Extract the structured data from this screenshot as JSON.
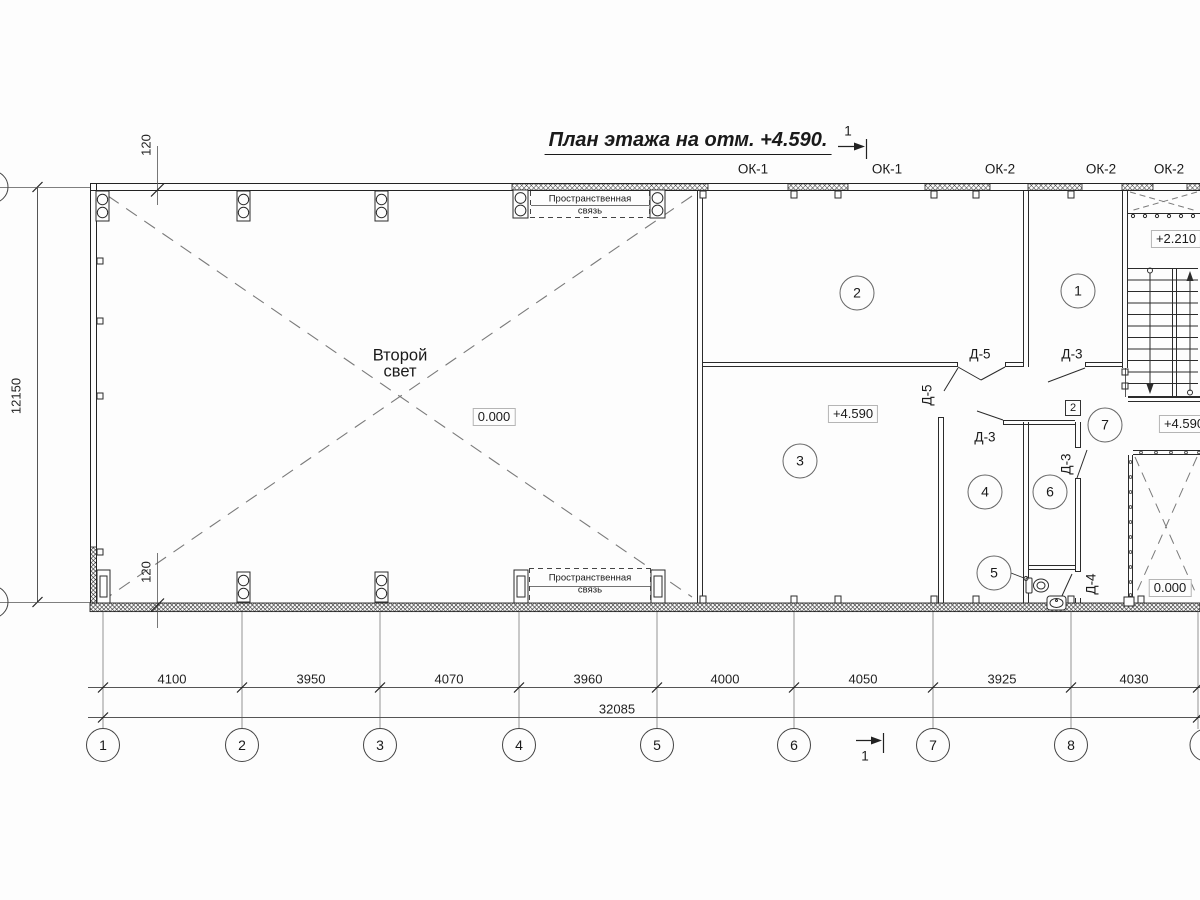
{
  "title": "План этажа на отм. +4.590.",
  "section": {
    "label": "1"
  },
  "windows": {
    "w1": "ОК-1",
    "w2": "ОК-1",
    "w3": "ОК-2",
    "w4": "ОК-2",
    "w5": "ОК-2"
  },
  "doors": {
    "d5_top": "Д-5",
    "d3_top": "Д-3",
    "d3_corr": "Д-3",
    "d5_side": "Д-5",
    "d3_side": "Д-3",
    "d4": "Д-4"
  },
  "rooms": {
    "r1": "1",
    "r2": "2",
    "r3": "3",
    "r4": "4",
    "r5": "5",
    "r6": "6",
    "r7": "7"
  },
  "marker_node": "2",
  "labels": {
    "second_light_1": "Второй",
    "second_light_2": "свет",
    "space_frame_1": "Пространственная",
    "space_frame_2": "связь"
  },
  "elevations": {
    "big_room": "0.000",
    "room3": "+4.590",
    "landing": "+2.210",
    "stair_right": "+4.590",
    "void": "0.000"
  },
  "dimensions": {
    "bays": [
      "4100",
      "3950",
      "4070",
      "3960",
      "4000",
      "4050",
      "3925",
      "4030"
    ],
    "total": "32085",
    "height": "12150",
    "offset_top": "120",
    "offset_bottom": "120"
  },
  "axes": [
    "1",
    "2",
    "3",
    "4",
    "5",
    "6",
    "7",
    "8"
  ]
}
